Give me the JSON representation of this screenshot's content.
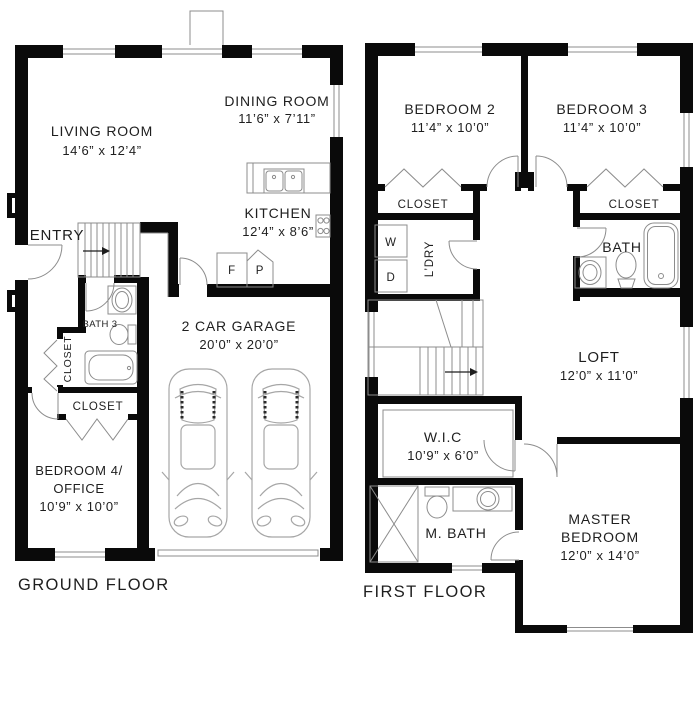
{
  "ground_floor": {
    "caption": "GROUND FLOOR",
    "rooms": {
      "living": {
        "name": "LIVING ROOM",
        "dims": "14’6” x 12’4”"
      },
      "dining": {
        "name": "DINING ROOM",
        "dims": "11’6” x 7’11”"
      },
      "kitchen": {
        "name": "KITCHEN",
        "dims": "12’4” x 8’6”"
      },
      "entry": {
        "name": "ENTRY"
      },
      "bath3": {
        "name": "BATH 3"
      },
      "closet_hall": {
        "name": "CLOSET"
      },
      "closet_bed4": {
        "name": "CLOSET"
      },
      "garage": {
        "name": "2 CAR GARAGE",
        "dims": "20’0” x 20’0”"
      },
      "bedroom4": {
        "line1": "BEDROOM 4/",
        "line2": "OFFICE",
        "dims": "10’9” x 10’0”"
      }
    },
    "appliances": {
      "fridge": "F",
      "pantry": "P"
    }
  },
  "first_floor": {
    "caption": "FIRST FLOOR",
    "rooms": {
      "bedroom2": {
        "name": "BEDROOM 2",
        "dims": "11’4” x 10’0”"
      },
      "bedroom3": {
        "name": "BEDROOM 3",
        "dims": "11’4” x 10’0”"
      },
      "closet2": {
        "name": "CLOSET"
      },
      "closet3": {
        "name": "CLOSET"
      },
      "laundry": {
        "name": "L’DRY",
        "washer": "W",
        "dryer": "D"
      },
      "bath": {
        "name": "BATH"
      },
      "loft": {
        "name": "LOFT",
        "dims": "12’0” x 11’0”"
      },
      "wic": {
        "name": "W.I.C",
        "dims": "10’9” x 6’0”"
      },
      "mbath": {
        "name": "M. BATH"
      },
      "master": {
        "line1": "MASTER",
        "line2": "BEDROOM",
        "dims": "12’0” x 14’0”"
      }
    }
  },
  "colors": {
    "wall": "#0a0a0a",
    "thin_line": "#8c8c8c",
    "text": "#1e1e1e",
    "background": "#ffffff"
  }
}
